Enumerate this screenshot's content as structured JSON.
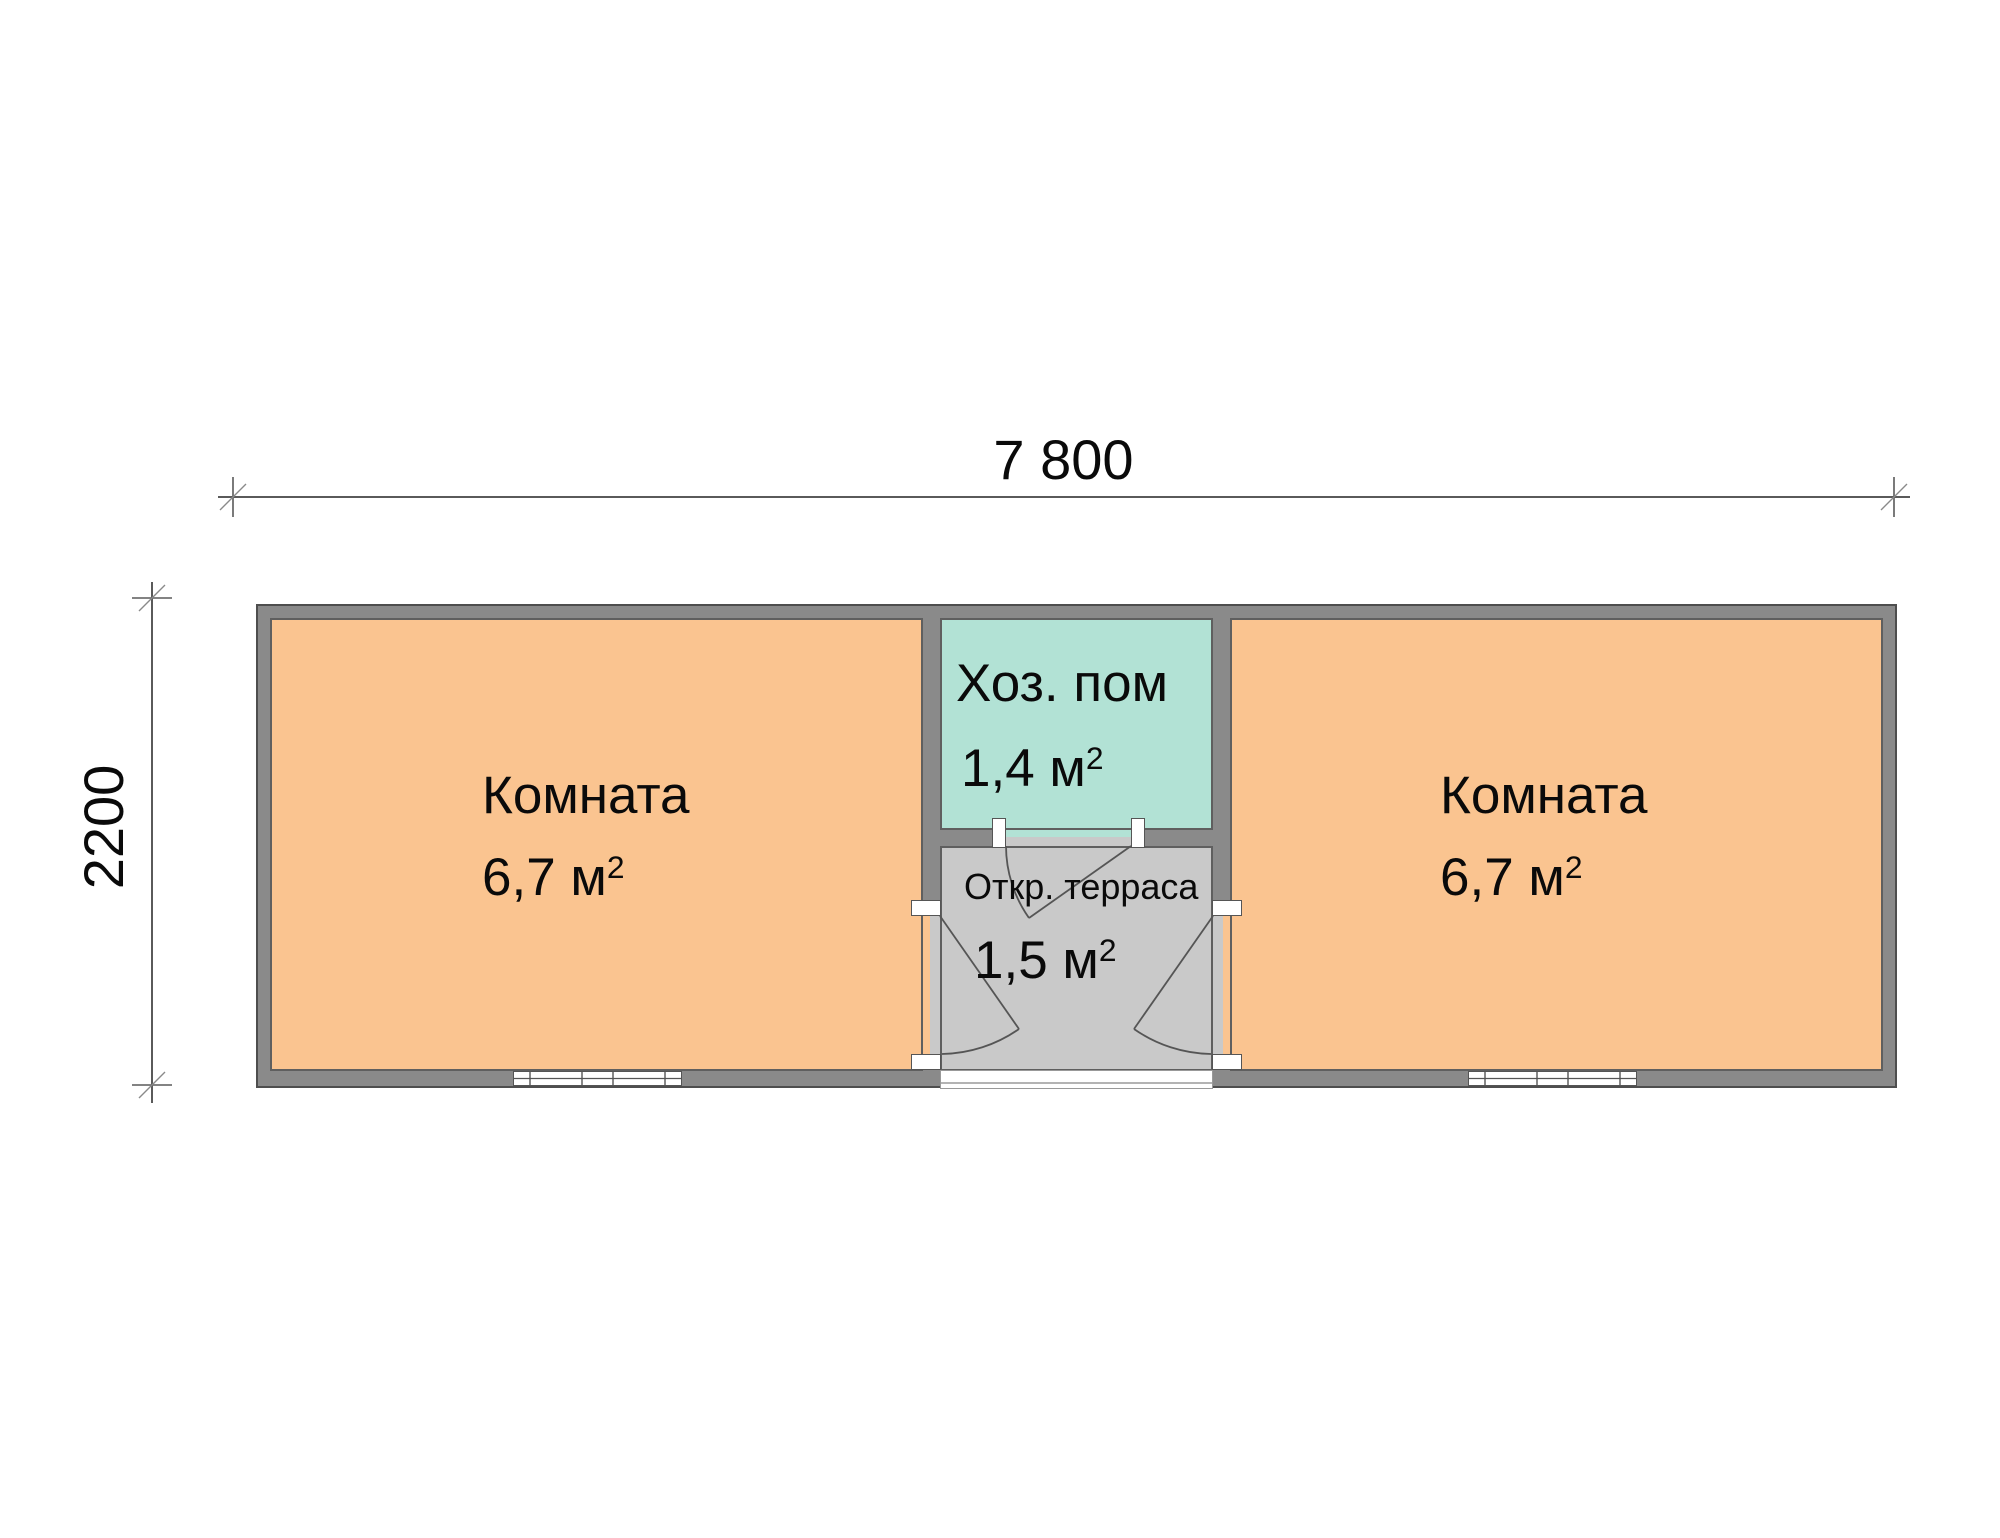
{
  "plan": {
    "dim_width_label": "7 800",
    "dim_height_label": "2200",
    "rooms": {
      "left": {
        "name": "Комната",
        "area": "6,7 м",
        "sup": "2"
      },
      "utility": {
        "name": "Хоз. пом",
        "area": "1,4 м",
        "sup": "2"
      },
      "terrace": {
        "name": "Откр. терраса",
        "area": "1,5 м",
        "sup": "2"
      },
      "right": {
        "name": "Комната",
        "area": "6,7 м",
        "sup": "2"
      }
    },
    "colors": {
      "room_fill": "#fac490",
      "utility_fill": "#b2e2d5",
      "terrace_fill": "#c9c9c9",
      "wall_fill": "#8a8a8a",
      "wall_outline": "#4e4e4e",
      "dim_line": "#5a5a5a"
    }
  }
}
